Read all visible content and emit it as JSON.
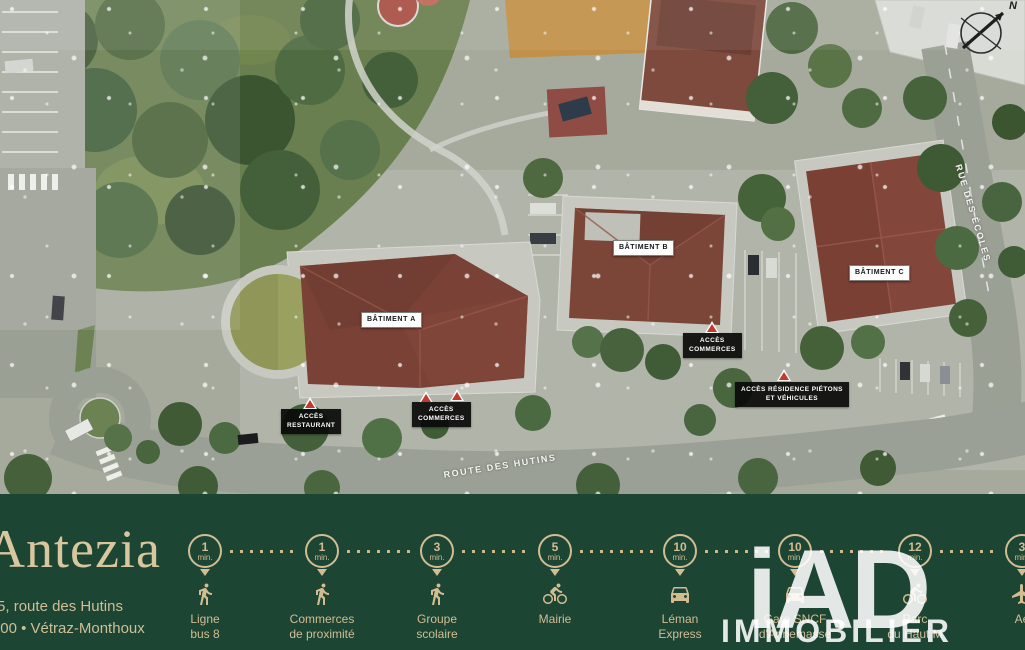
{
  "map": {
    "buildings": [
      {
        "label": "BÂTIMENT A"
      },
      {
        "label": "BÂTIMENT B"
      },
      {
        "label": "BÂTIMENT C"
      }
    ],
    "access": [
      {
        "line1": "ACCÈS",
        "line2": "RESTAURANT"
      },
      {
        "line1": "ACCÈS",
        "line2": "COMMERCES"
      },
      {
        "line1": "ACCÈS",
        "line2": "COMMERCES"
      },
      {
        "line1": "ACCÈS RÉSIDENCE PIÉTONS",
        "line2": "ET VÉHICULES"
      }
    ],
    "streets": [
      {
        "name": "ROUTE DES HUTINS"
      },
      {
        "name": "RUE DES ÉCOLES"
      }
    ],
    "compass_label": "N"
  },
  "banner": {
    "brand": "Antezia",
    "address_line1": "5, route des Hutins",
    "address_line2": "74100 • Vétraz-Monthoux",
    "colors": {
      "background": "#1c4534",
      "gold": "#d2bd93",
      "warning_red": "#c23a2e"
    },
    "items": [
      {
        "time": "1",
        "unit": "min.",
        "icon": "walk",
        "line1": "Ligne",
        "line2": "bus 8"
      },
      {
        "time": "1",
        "unit": "min.",
        "icon": "walk",
        "line1": "Commerces",
        "line2": "de proximité"
      },
      {
        "time": "3",
        "unit": "min.",
        "icon": "walk",
        "line1": "Groupe",
        "line2": "scolaire"
      },
      {
        "time": "5",
        "unit": "min.",
        "icon": "bike",
        "line1": "Mairie",
        "line2": ""
      },
      {
        "time": "10",
        "unit": "min.",
        "icon": "car",
        "line1": "Léman",
        "line2": "Express"
      },
      {
        "time": "10",
        "unit": "min.",
        "icon": "car",
        "line1": "Gare SNCF",
        "line2": "d'Annemasse"
      },
      {
        "time": "12",
        "unit": "min.",
        "icon": "bike",
        "line1": "Parc",
        "line2": "du Haut M"
      },
      {
        "time": "3",
        "unit": "min.",
        "icon": "plane",
        "line1": "Aé",
        "line2": ""
      }
    ],
    "watermark": {
      "top": "iAD",
      "bottom": "IMMOBILIER"
    }
  }
}
